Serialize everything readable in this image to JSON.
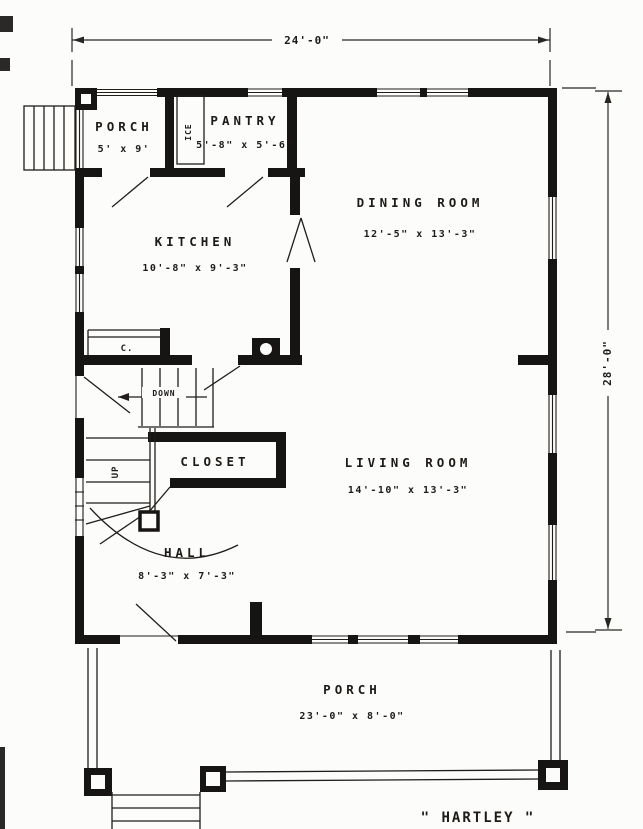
{
  "colors": {
    "ink": "#1d1a17",
    "paper": "#fcfcfa",
    "wall": "#171513"
  },
  "plan": {
    "title": "\" HARTLEY \"",
    "dim_width": "24'-0\"",
    "dim_height": "28'-0\"",
    "rooms": {
      "porch_top": {
        "name": "PORCH",
        "dims": "5' x 9'"
      },
      "pantry": {
        "name": "PANTRY",
        "dims": "5'-8\" x 5'-6\""
      },
      "dining_room": {
        "name": "DINING ROOM",
        "dims": "12'-5\" x 13'-3\""
      },
      "kitchen": {
        "name": "KITCHEN",
        "dims": "10'-8\" x 9'-3\""
      },
      "closet": {
        "name": "CLOSET"
      },
      "living_room": {
        "name": "LIVING ROOM",
        "dims": "14'-10\" x 13'-3\""
      },
      "hall": {
        "name": "HALL",
        "dims": "8'-3\" x 7'-3\""
      },
      "porch_bottom": {
        "name": "PORCH",
        "dims": "23'-0\" x 8'-0\""
      }
    },
    "annotations": {
      "icebox": "ICE",
      "coat_closet": "C.",
      "stairs_up": "UP",
      "stairs_down": "DOWN"
    }
  }
}
